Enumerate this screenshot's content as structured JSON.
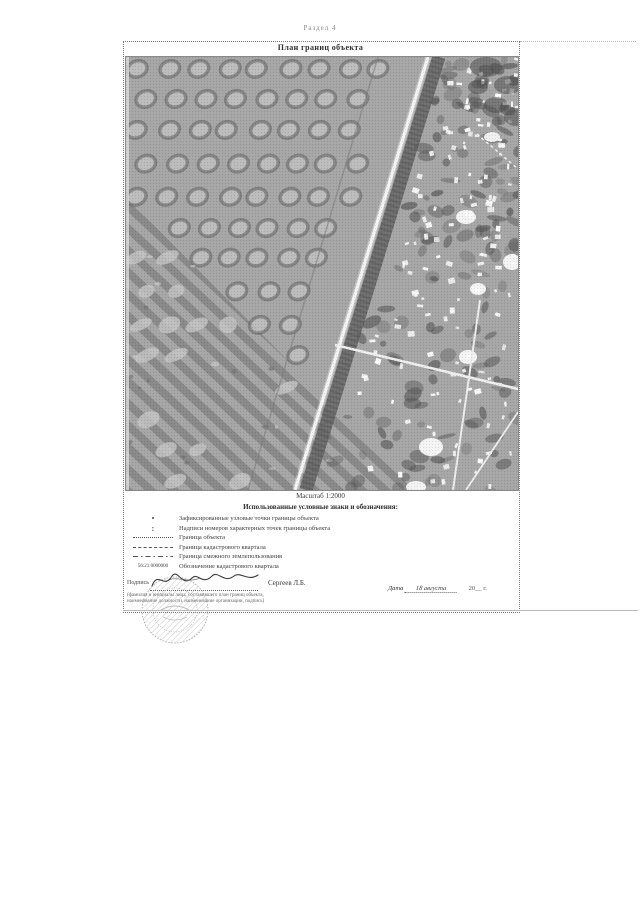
{
  "page": {
    "header": "Раздел 4"
  },
  "plan": {
    "title": "План границ объекта",
    "scale": "Масштаб 1:2000",
    "legend": {
      "heading": "Использованные условные знаки и обозначения:",
      "items": [
        {
          "symbol": "point",
          "glyph": "•",
          "label": "Зафиксированные узловые точки границы объекта"
        },
        {
          "symbol": "colon",
          "glyph": ":",
          "label": "Надписи номеров характерных точек границы объекта"
        },
        {
          "symbol": "dotted-line",
          "glyph": "",
          "label": "Граница объекта"
        },
        {
          "symbol": "dashed-line",
          "glyph": "",
          "label": "Граница кадастрового квартала"
        },
        {
          "symbol": "dashdot-line",
          "glyph": "",
          "label": "Граница смежного землепользования"
        },
        {
          "symbol": "cadastral-number",
          "glyph": "56:21:0000000",
          "label": "Обозначение кадастрового квартала"
        }
      ]
    },
    "signature": {
      "label": "Подпись",
      "name": "Сергеев Л.Б.",
      "note_line1": "(фамилия и инициалы лица, составившего план границ объекта,",
      "note_line2": "наименование должности, наименование организации, подпись)"
    },
    "date": {
      "label": "Дата",
      "written": "18 августа",
      "suffix": "20__ г."
    }
  },
  "photo": {
    "description": "aerial-photo-orchard-field-road-village",
    "colors": {
      "base": "#a6a6a6",
      "tree_ring": "#5e5e5e",
      "tree_center": "#c0c0c0",
      "field_stripe": "#7e7e7e",
      "road_white": "#f4f4f4",
      "road_band": "#656565",
      "house_white": "#fbfbfb",
      "village_dark": "#595959"
    }
  }
}
